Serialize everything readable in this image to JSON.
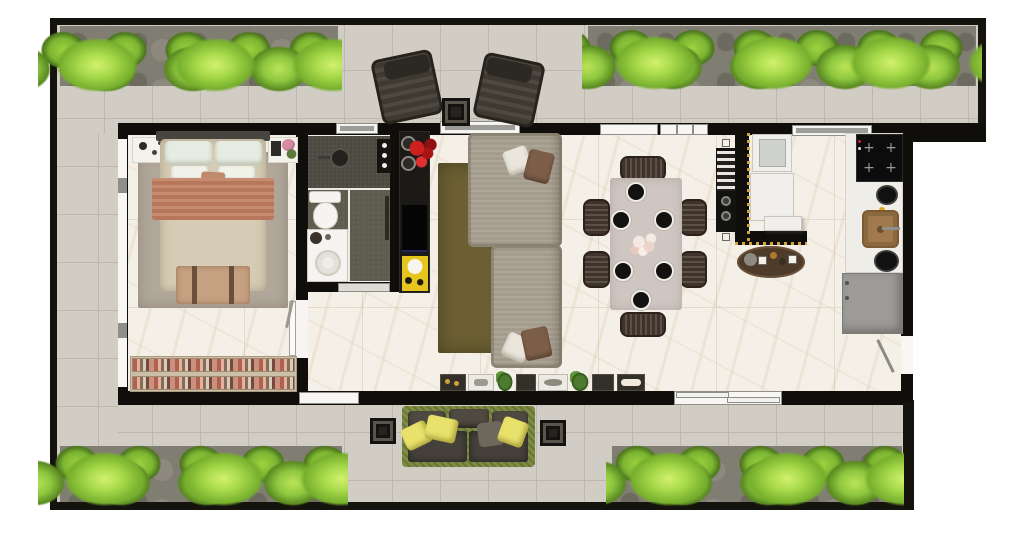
{
  "canvas": {
    "width": 1024,
    "height": 539,
    "background": "#ffffff"
  },
  "scene": "apartment-floor-plan-top-view-render",
  "palette": {
    "hedge_green": "#8cc63e",
    "terrace_tile": "#d2cdc4",
    "wall_black": "#0f0e0b",
    "marble_floor": "#f4f0e7",
    "bathroom_floor": "#5e5c4e",
    "bed_throw_terracotta": "#c07f61",
    "sofa_gray": "#a9a192",
    "living_rug_olive": "#6b5f33",
    "outdoor_pillow_yellow": "#e8e16b",
    "accent_art_yellow": "#e7c51f",
    "flowers_red": "#cf2020",
    "sink_wood": "#a07a4e",
    "fridge_gray": "#9c9b97"
  },
  "counts": {
    "hedge_sections": 4,
    "terrace_lounge_chairs": 2,
    "terrace_side_tables": 3,
    "dining_chairs": 6,
    "place_settings": 6,
    "sofa_pillows": 4,
    "outdoor_yellow_pillows": 3,
    "wardrobe_clothing_rows": 2
  },
  "labels": {
    "plan": "apartment floor plan render",
    "terrace": "wrap-around terrace with hedges",
    "bedroom": "bedroom with double bed and wardrobe",
    "bathroom": "bathroom with shower, toilet and vanity",
    "corridor": "corridor to bedroom and bathroom",
    "living": "living room with sectional sofa and tv console",
    "dining": "dining table for six",
    "laundry": "laundry nook with washer and counter",
    "kitchen": "kitchen counter with cooktop, sink and fridge",
    "bed": "double bed",
    "sofa": "sectional sofa",
    "tv_console": "tv console with red flowers and yellow art",
    "dining_table": "dining table with six place settings",
    "outdoor_sofa": "outdoor sofa with yellow pillows",
    "lounge_chairs": "pair of terrace lounge chairs",
    "grill_counter": "balcony grill counter with trays and herbs",
    "wardrobe": "open wardrobe with hanging clothes",
    "fridge": "refrigerator",
    "cooktop": "induction cooktop",
    "sink": "wooden kitchen sink",
    "bar_table": "oval bar tray table",
    "washer": "laundry tub and washer"
  }
}
